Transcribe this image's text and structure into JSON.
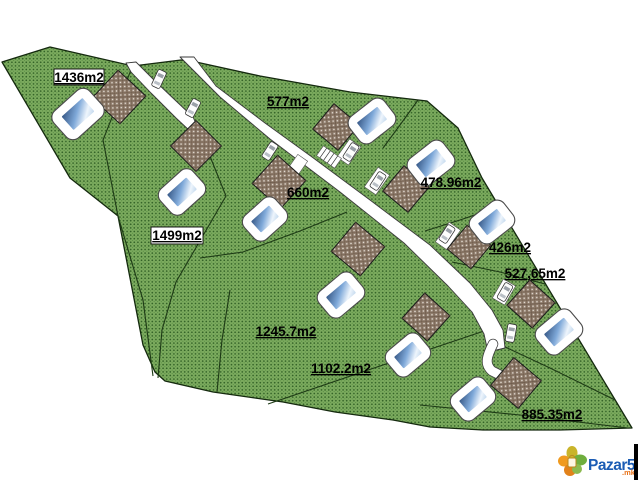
{
  "plan": {
    "parcels": [
      {
        "area_label": "1436m2",
        "boxed": true
      },
      {
        "area_label": "1499m2",
        "boxed": true
      },
      {
        "area_label": "577m2",
        "boxed": false
      },
      {
        "area_label": "660m2",
        "boxed": false
      },
      {
        "area_label": "478.96m2",
        "boxed": false
      },
      {
        "area_label": "426m2",
        "boxed": false
      },
      {
        "area_label": "527,65m2",
        "boxed": false
      },
      {
        "area_label": "1245.7m2",
        "boxed": false
      },
      {
        "area_label": "1102.2m2",
        "boxed": false
      },
      {
        "area_label": "885.35m2",
        "boxed": false
      }
    ],
    "feature_counts": {
      "houses": 10,
      "pools": 10,
      "cars": 8
    }
  },
  "watermark": {
    "brand": "Pazar5",
    "tld": ".mk"
  },
  "colors": {
    "terrain_green": "#7dac5f",
    "terrain_dot": "#336327",
    "roof_brown": "#8e7b6b",
    "pool_blue": "#5b8fc7",
    "road_white": "#ffffff",
    "label_text": "#000000",
    "brand_blue": "#1b5cb4",
    "brand_orange": "#e8731a"
  }
}
